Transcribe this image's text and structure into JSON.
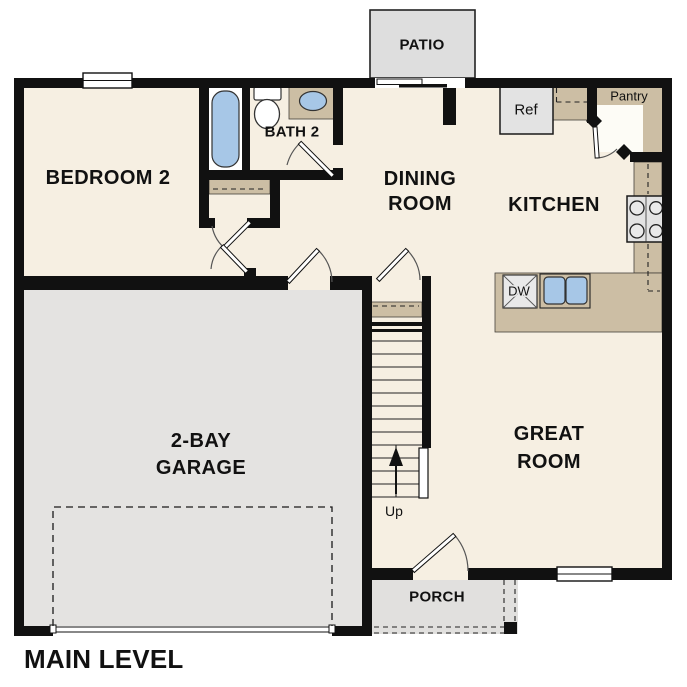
{
  "plan_title": "MAIN LEVEL",
  "rooms": {
    "bedroom2": "BEDROOM 2",
    "bath2": "BATH 2",
    "dining_line1": "DINING",
    "dining_line2": "ROOM",
    "kitchen": "KITCHEN",
    "great_line1": "GREAT",
    "great_line2": "ROOM",
    "garage_line1": "2-BAY",
    "garage_line2": "GARAGE",
    "patio": "PATIO",
    "porch": "PORCH",
    "pantry": "Pantry"
  },
  "fixtures": {
    "refrigerator": "Ref",
    "dishwasher": "DW",
    "stairs_direction": "Up"
  },
  "colors": {
    "floor_cream": "#f6efe2",
    "cabinet_tan": "#ccbea4",
    "garage_gray": "#e4e3e1",
    "patio_gray": "#dedede",
    "porch_gray": "#e1e0de",
    "fixture_blue": "#a7c7e7",
    "appliance_gray": "#e3e3e3",
    "wall_black": "#111111"
  }
}
